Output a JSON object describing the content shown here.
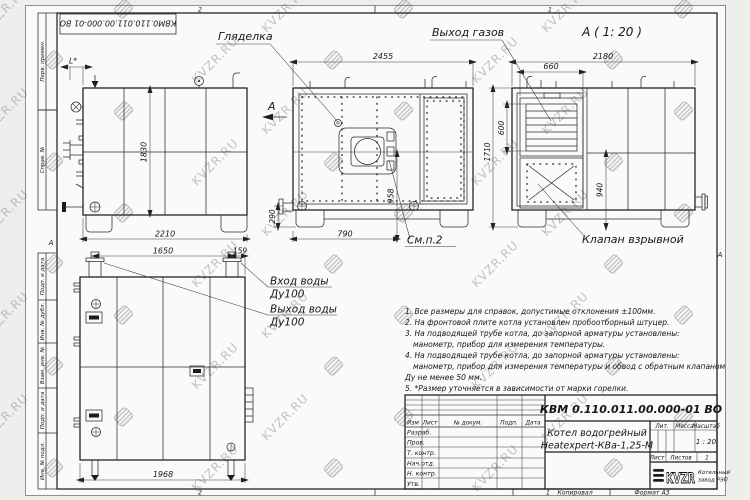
{
  "watermark": {
    "text": "KVZR.RU"
  },
  "frame": {
    "stamp_doc_number": "КВМ0.110.011.00.000-01 ВО",
    "col_labels_top": [
      "Перв. примен.",
      "Справ. №"
    ],
    "col_labels_bottom": [
      "Подп. и дата",
      "Инв. № дубл.",
      "Взам. инв. №",
      "Подп. и дата",
      "Инв. № подл."
    ],
    "zone_letter": "А",
    "zone_1": "1",
    "zone_2": "2"
  },
  "callouts": {
    "sight_glass": "Гляделка",
    "gas_outlet": "Выход газов",
    "view_a_title": "А ( 1: 20 )",
    "explosion_valve": "Клапан взрывной",
    "see_note2": "См.п.2",
    "water_inlet": "Вход воды",
    "water_inlet_dn": "Ду100",
    "water_outlet": "Выход воды",
    "water_outlet_dn": "Ду100",
    "section_letter": "А"
  },
  "dims": {
    "l_star": "L*",
    "side_height": "1830",
    "side_width": "2210",
    "front_width": "2455",
    "front_burner_height": "958",
    "front_burner_x": "790",
    "front_nozzle": "290",
    "rear_width": "2180",
    "rear_outlet_width": "660",
    "rear_outlet_height": "600",
    "rear_height": "1710",
    "rear_valve_height": "940",
    "top_nozzle_span": "1650",
    "top_nozzle_offset": "159",
    "top_length": "1968"
  },
  "notes": [
    "1. Все размеры для справок, допустимые отклонения ±100мм.",
    "2. На фронтовой плите котла установлен пробоотборный штуцер.",
    "3. На подводящей трубе котла, до запорной арматуры установлены:",
    "манометр, прибор для измерения температуры.",
    "4. На подводящей трубе котла, до запорной арматуры установлены:",
    "манометр, прибор для измерения температуры и обвод с обратным клапаном",
    "Ду не менее 50 мм.",
    "5. *Размер уточняется в зависимости от марки горелки."
  ],
  "title_block": {
    "doc_number": "КВМ 0.110.011.00.000-01 ВО",
    "name_line1": "Котел водогрейный",
    "name_line2": "Heatexpert-КВа-1,25-М",
    "cols": [
      "Изм",
      "Лист",
      "№ докум.",
      "Подп.",
      "Дата"
    ],
    "rows": [
      "Разраб.",
      "Пров.",
      "Т. контр.",
      "Нач.отд.",
      "Н. контр.",
      "Утв."
    ],
    "lit": "Лит.",
    "mass": "Масса",
    "scale": "Масштаб",
    "scale_value": "1 : 20",
    "sheet": "Лист",
    "sheets": "Листов",
    "sheets_value": "1",
    "logo": "KVZR",
    "logo_caption1": "Котельный",
    "logo_caption2": "завод РЭП",
    "copied": "Копировал",
    "format": "Формат А3"
  }
}
